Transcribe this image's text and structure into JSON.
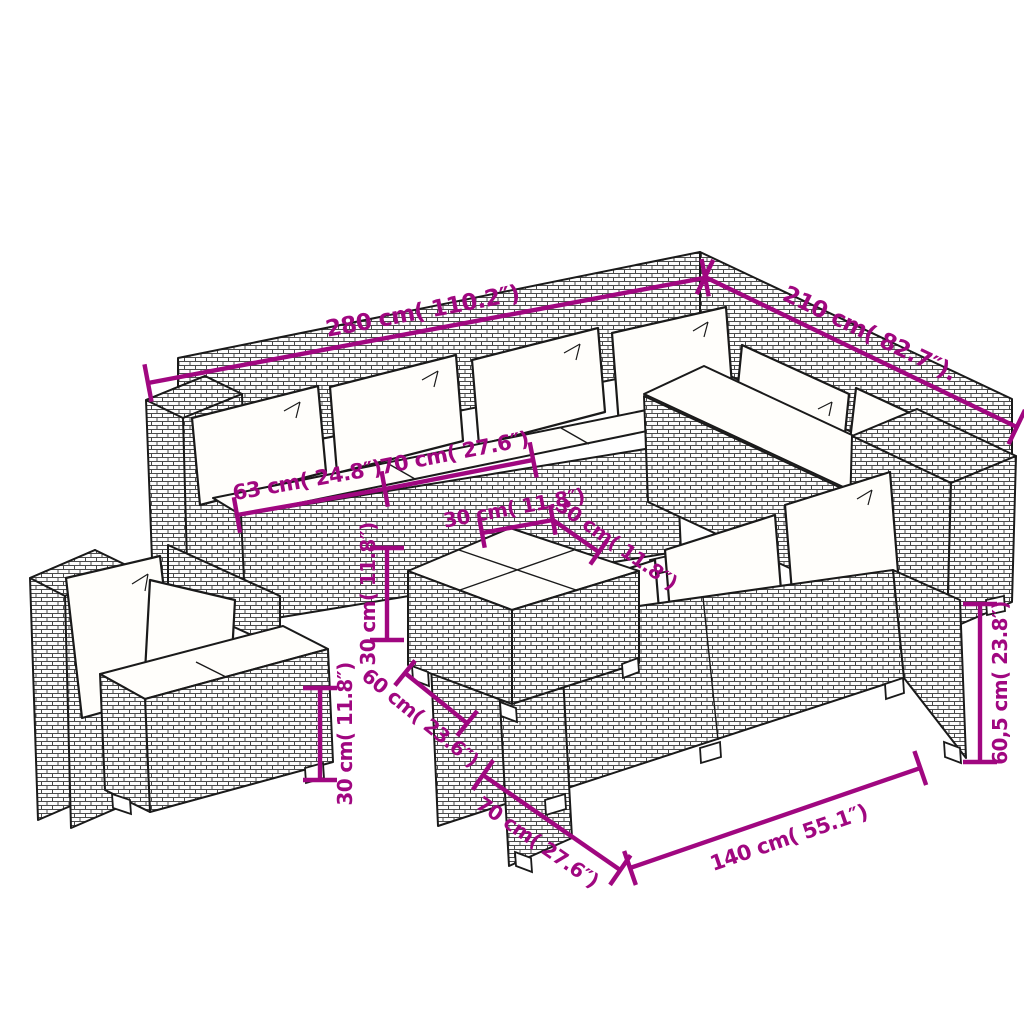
{
  "diagram": {
    "kind": "furniture-dimension-diagram",
    "subject": "rattan garden lounge set with cushions",
    "colors": {
      "dimension_accent": "#A00780",
      "outline": "#1A1A1A",
      "cushion": "#FFFEFB",
      "wicker_line": "#4A4A4A",
      "background": "#FFFFFF"
    }
  },
  "dims": {
    "top_width": "280 cm( 110.2″)",
    "top_depth": "210 cm( 82.7″).",
    "corner_seat_width": "63 cm( 24.8″)",
    "seat_module_width": "70 cm( 27.6″)",
    "table_half_left": "30 cm( 11.8″)",
    "table_half_right": "30 cm( 11.8″)",
    "table_height": "30 cm( 11.8″)",
    "table_width": "60 cm( 23.6″)",
    "ottoman_height": "30 cm( 11.8″)",
    "sofa_height": "60,5 cm( 23.8″)",
    "sofa_width": "140 cm( 55.1″)",
    "sofa_depth": "70 cm( 27.6″)"
  }
}
